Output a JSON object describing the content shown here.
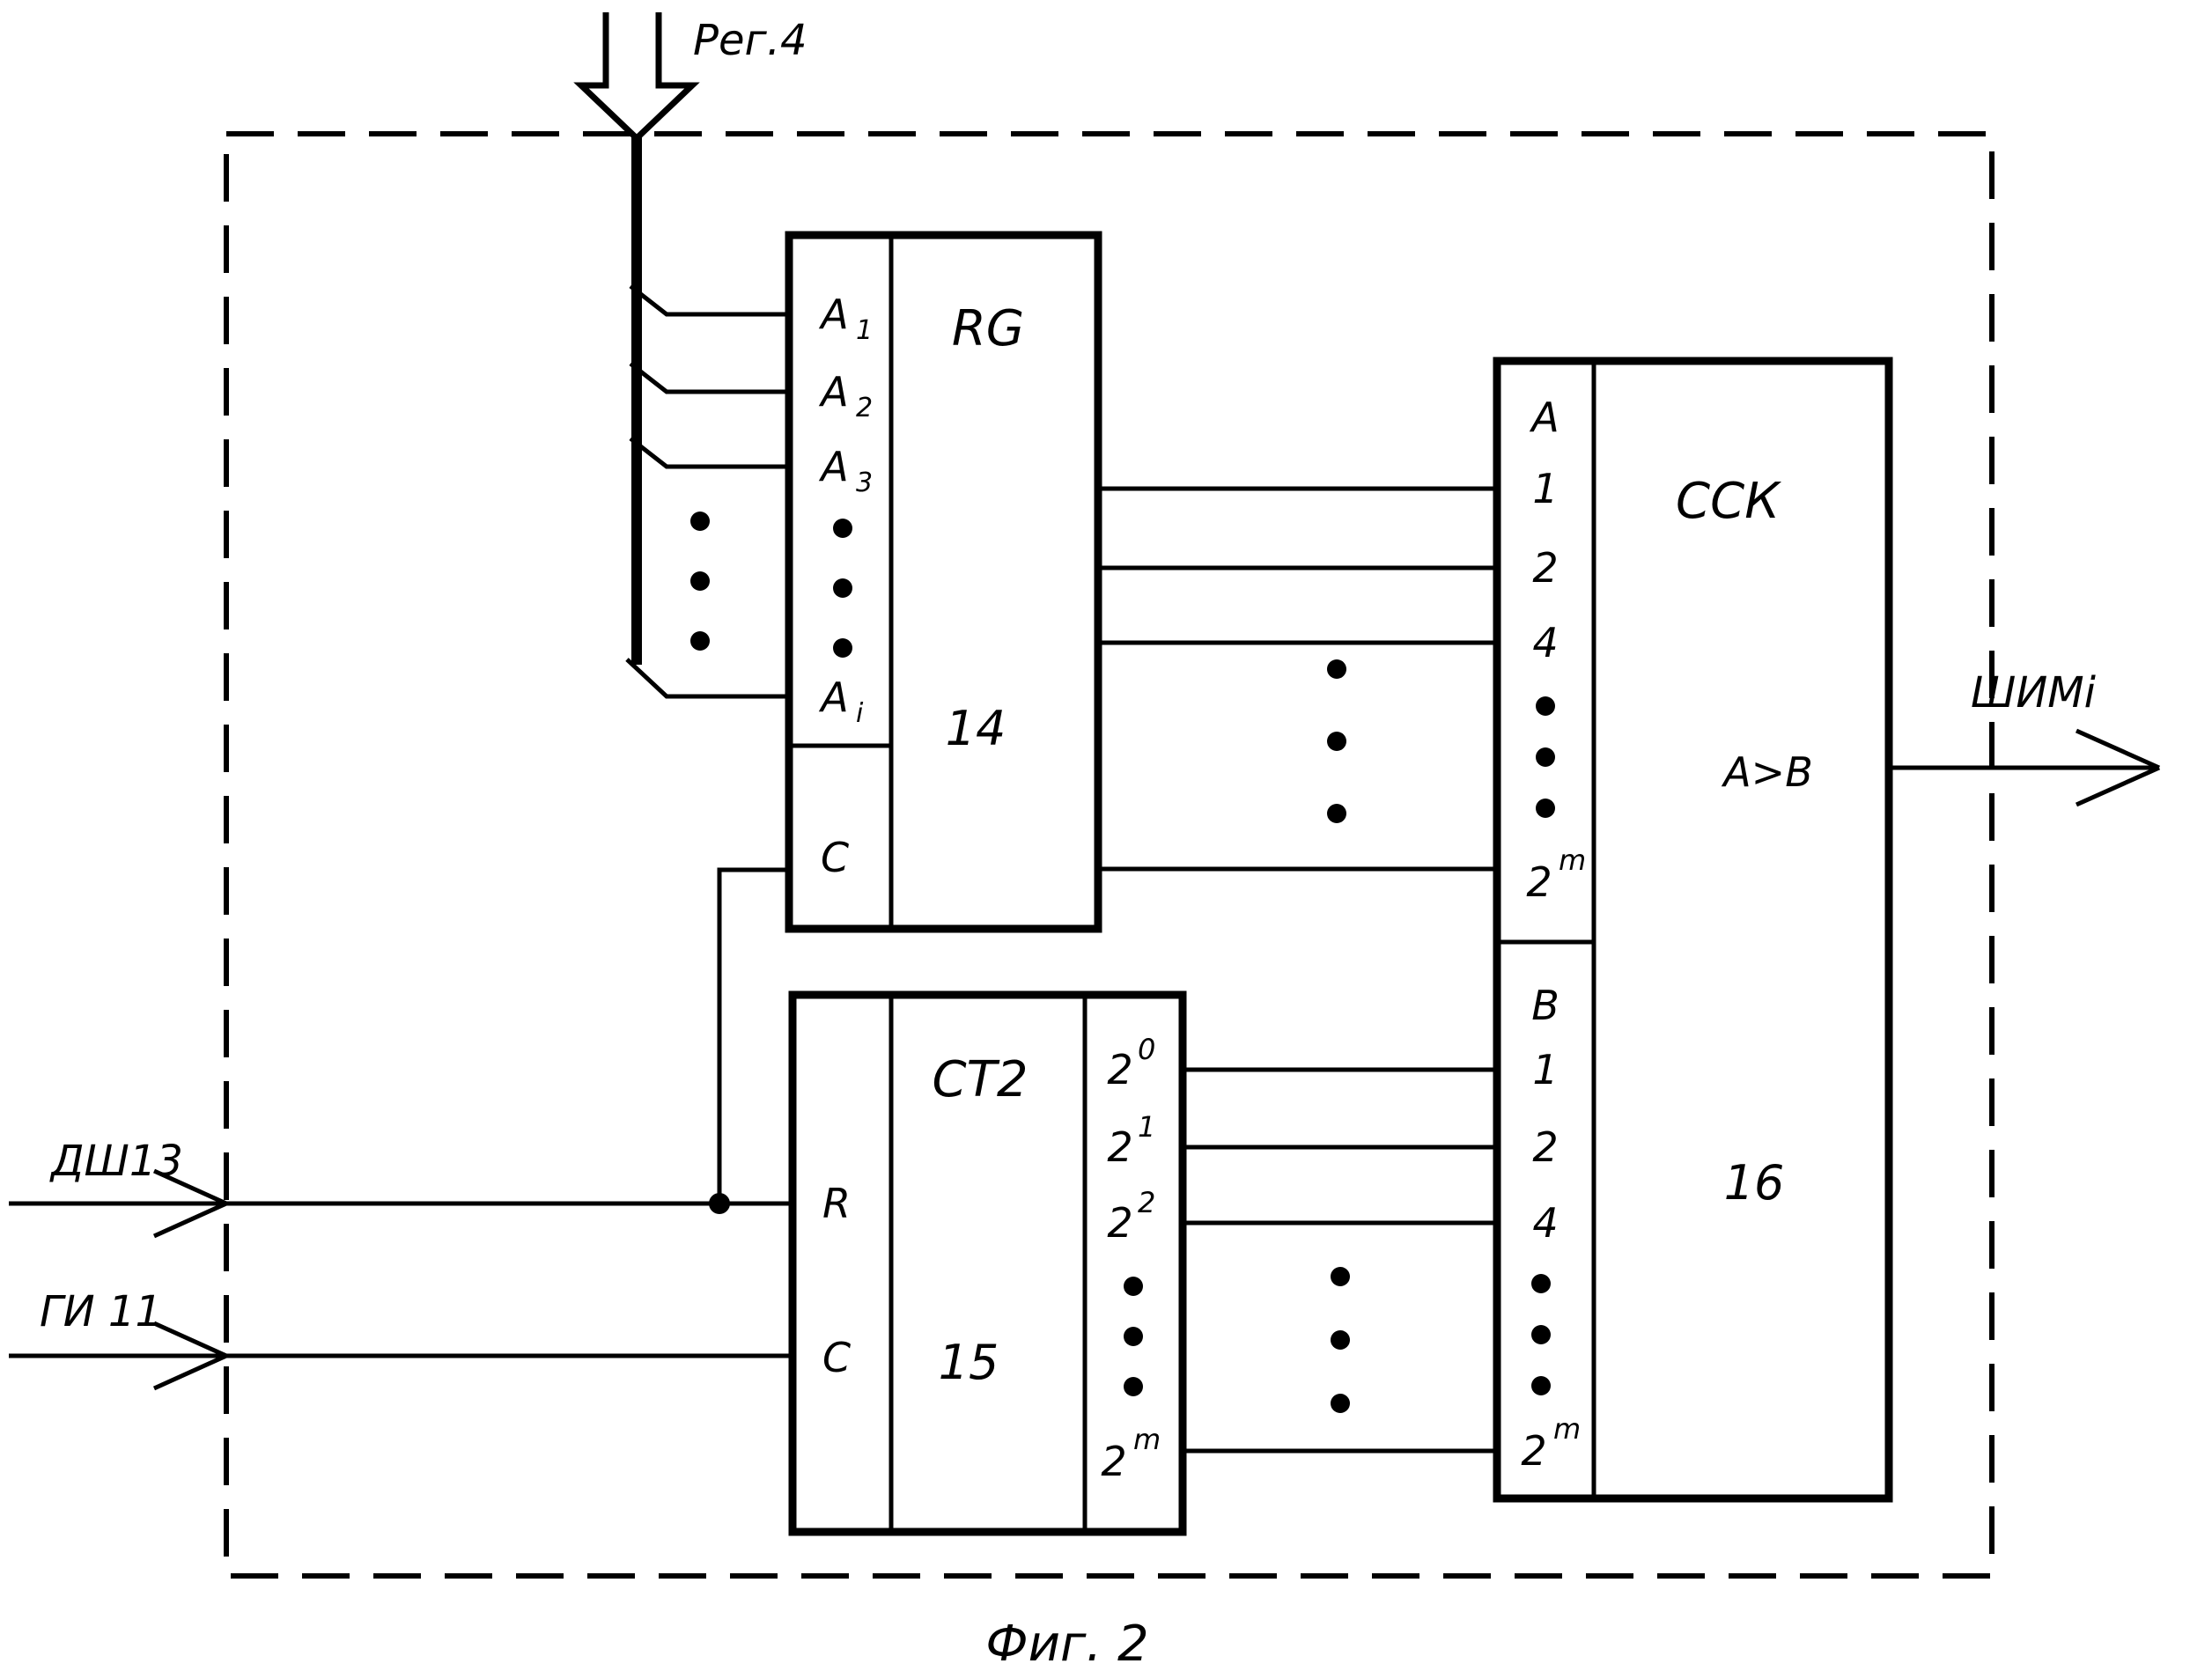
{
  "figure": {
    "caption": "Фиг. 2",
    "ink_color": "#000000",
    "background_color": "#ffffff"
  },
  "external": {
    "top_bus_label": "Рег.4",
    "left_input_1_label": "ДШ13",
    "left_input_2_label": "ГИ 11",
    "output_label": "ШИМi"
  },
  "blocks": {
    "rg": {
      "type_label": "RG",
      "number": "14",
      "clock_label": "C",
      "inputs": [
        {
          "base": "A",
          "sub": "1"
        },
        {
          "base": "A",
          "sub": "2"
        },
        {
          "base": "A",
          "sub": "3"
        },
        {
          "base": "A",
          "sub": "i"
        }
      ]
    },
    "ct2": {
      "type_label": "CT2",
      "number": "15",
      "reset_label": "R",
      "clock_label": "C",
      "outputs": [
        {
          "base": "2",
          "sup": "0"
        },
        {
          "base": "2",
          "sup": "1"
        },
        {
          "base": "2",
          "sup": "2"
        },
        {
          "base": "2",
          "sup": "m"
        }
      ]
    },
    "cck": {
      "type_label": "ССК",
      "number": "16",
      "compare_label": "A>B",
      "section_a": {
        "header": "A",
        "rows": [
          "1",
          "2",
          "4"
        ],
        "last": {
          "base": "2",
          "sup": "m"
        }
      },
      "section_b": {
        "header": "B",
        "rows": [
          "1",
          "2",
          "4"
        ],
        "last": {
          "base": "2",
          "sup": "m"
        }
      }
    }
  }
}
